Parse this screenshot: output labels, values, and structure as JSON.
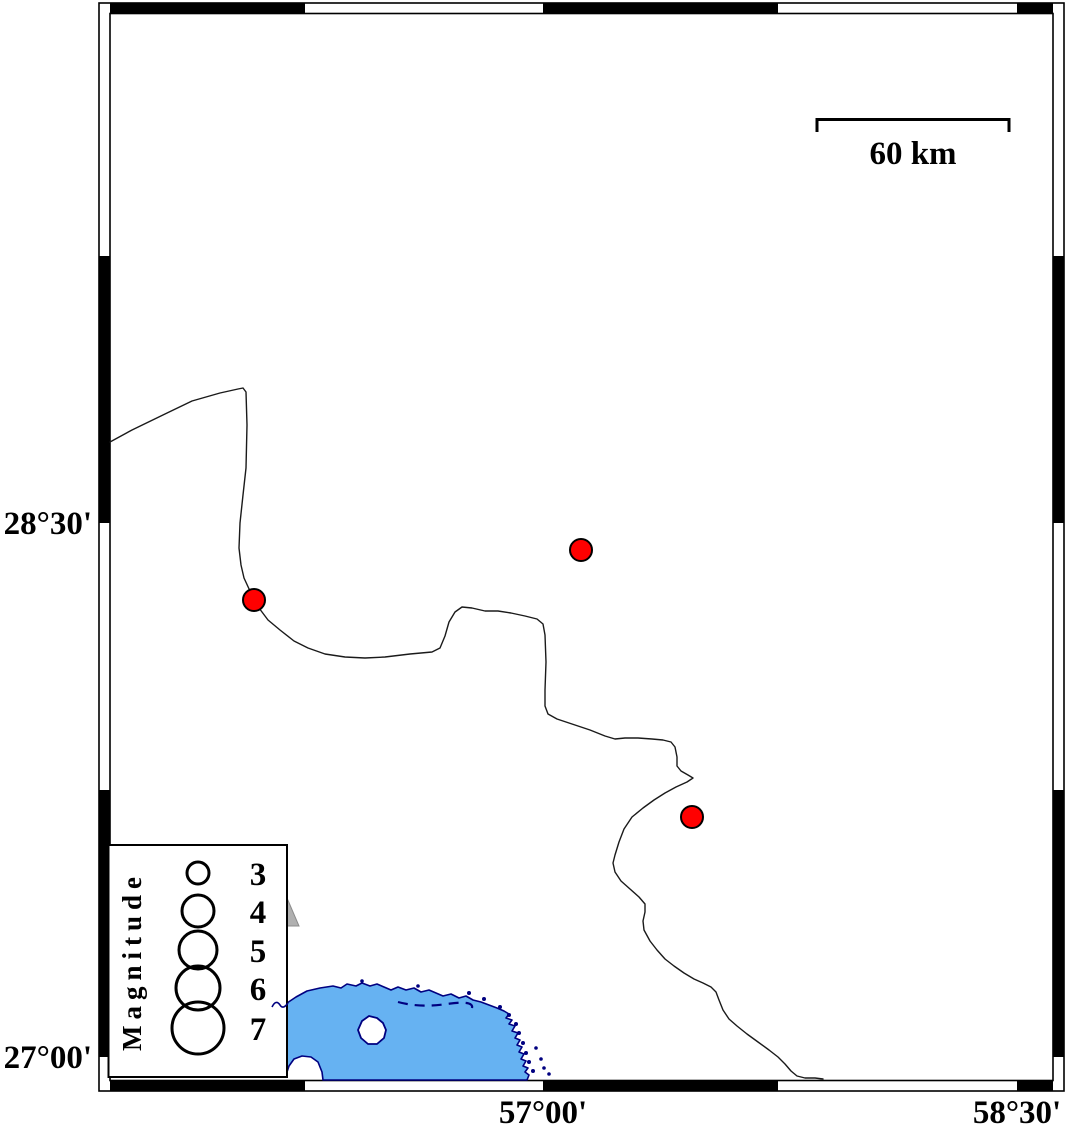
{
  "map": {
    "type": "seismicity-map",
    "axes": {
      "left_labels": [
        {
          "text": "28°30'",
          "px_y": 523
        },
        {
          "text": "27°00'",
          "px_y": 1057
        }
      ],
      "bottom_labels": [
        {
          "text": "57°00'",
          "px_x": 543
        },
        {
          "text": "58°30'",
          "px_x": 1017
        }
      ]
    },
    "scale_bar": {
      "label": "60 km"
    },
    "legend": {
      "title": "Magnitude",
      "entries": [
        {
          "label": "3",
          "radius_px": 11
        },
        {
          "label": "4",
          "radius_px": 16
        },
        {
          "label": "5",
          "radius_px": 19
        },
        {
          "label": "6",
          "radius_px": 22
        },
        {
          "label": "7",
          "radius_px": 26
        }
      ]
    },
    "epicenters": [
      {
        "px_x": 581,
        "px_y": 550,
        "approx_lon": "57°07'E",
        "approx_lat": "28°25'N",
        "approx_magnitude": 3
      },
      {
        "px_x": 254,
        "px_y": 600,
        "approx_lon": "56°05'E",
        "approx_lat": "28°17'N",
        "approx_magnitude": 3
      },
      {
        "px_x": 692,
        "px_y": 817,
        "approx_lon": "57°28'E",
        "approx_lat": "27°40'N",
        "approx_magnitude": 3
      }
    ],
    "colors": {
      "epicenter_fill": "#ff0000",
      "sea_fill": "#66b2f2",
      "sea_outline": "#000080",
      "coastline": "#1a1a1a",
      "frame": "#000000",
      "triangle_fill": "#b0b0b0"
    }
  }
}
